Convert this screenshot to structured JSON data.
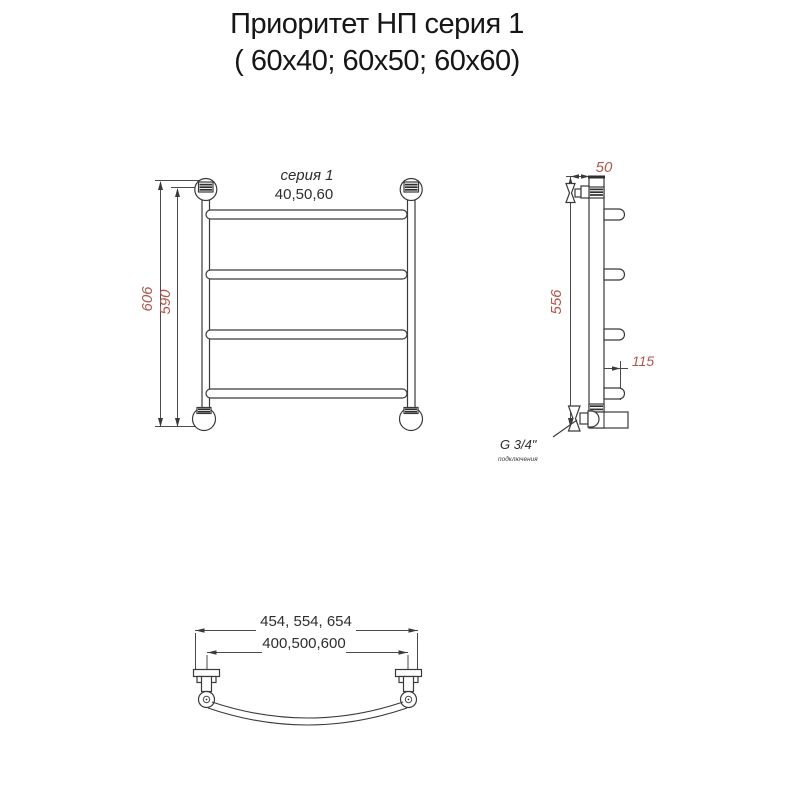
{
  "title": {
    "line1": "Приоритет НП серия 1",
    "line2": "( 60х40; 60х50; 60х60)"
  },
  "front_view": {
    "name_label": "серия 1",
    "widths_label": "40,50,60",
    "overall_height": "606",
    "mount_height": "590"
  },
  "side_view": {
    "top_offset": "50",
    "mount_height": "556",
    "depth": "115",
    "thread": "G 3/4\"",
    "thread_note": "подключения"
  },
  "bottom_view": {
    "overall_widths": "454, 554, 654",
    "mount_widths": "400,500,600"
  },
  "colors": {
    "background": "#ffffff",
    "line": "#3a3a3a",
    "dim_text": "#b0584c",
    "label_text": "#2e2e2e",
    "title_text": "#161616"
  }
}
